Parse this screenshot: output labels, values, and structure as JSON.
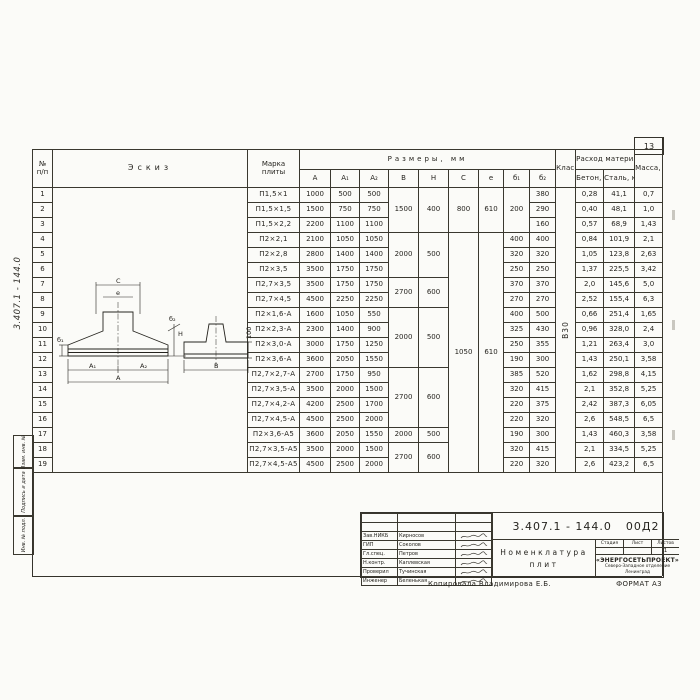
{
  "page": {
    "sheet_number": "13",
    "margin_doc_number": "3.407.1 - 144.0",
    "stamps": [
      "Взам. инв. №",
      "Подпись и дата",
      "Инв. № подл."
    ],
    "footer_note": "Копировала  Владимирова Е.Б.",
    "footer_format": "ФОРМАТ А3"
  },
  "table": {
    "header": {
      "num_top": "№",
      "num_bottom": "п/п",
      "sketch": "Эскиз",
      "mark_1": "Марка",
      "mark_2": "плиты",
      "dims": "Размеры,  мм",
      "dim_cols": [
        "A",
        "A₁",
        "A₂",
        "B",
        "H",
        "C",
        "e",
        "б₁",
        "б₂"
      ],
      "concrete_class": "Класс бетона",
      "materials": "Расход материалов",
      "material_cols": [
        "Бетон, м³",
        "Сталь, кг"
      ],
      "mass": "Масса, т"
    },
    "rows": [
      [
        {
          "t": "1",
          "n": "row-num"
        },
        {
          "t": "",
          "rs": 19,
          "k": "sk",
          "n": "sketch-cell"
        },
        {
          "t": "П1,5×1",
          "k": "mk",
          "n": "plate-mark"
        },
        {
          "t": "1000"
        },
        {
          "t": "500"
        },
        {
          "t": "500"
        },
        {
          "t": "1500",
          "rs": 3
        },
        {
          "t": "400",
          "rs": 3
        },
        {
          "t": "800",
          "rs": 3
        },
        {
          "t": "610",
          "rs": 3
        },
        {
          "t": "200",
          "rs": 3
        },
        {
          "t": "380"
        },
        {
          "t": "В30",
          "rs": 19,
          "k": "vc",
          "n": "concrete-class"
        },
        {
          "t": "0,28"
        },
        {
          "t": "41,1"
        },
        {
          "t": "0,7"
        }
      ],
      [
        {
          "t": "2",
          "n": "row-num"
        },
        {
          "t": "П1,5×1,5",
          "k": "mk",
          "n": "plate-mark"
        },
        {
          "t": "1500"
        },
        {
          "t": "750"
        },
        {
          "t": "750"
        },
        {
          "t": "290"
        },
        {
          "t": "0,40"
        },
        {
          "t": "48,1"
        },
        {
          "t": "1,0"
        }
      ],
      [
        {
          "t": "3",
          "n": "row-num"
        },
        {
          "t": "П1,5×2,2",
          "k": "mk",
          "n": "plate-mark"
        },
        {
          "t": "2200"
        },
        {
          "t": "1100"
        },
        {
          "t": "1100"
        },
        {
          "t": "160"
        },
        {
          "t": "0,57"
        },
        {
          "t": "68,9"
        },
        {
          "t": "1,43"
        }
      ],
      [
        {
          "t": "4",
          "n": "row-num"
        },
        {
          "t": "П2×2,1",
          "k": "mk",
          "n": "plate-mark"
        },
        {
          "t": "2100"
        },
        {
          "t": "1050"
        },
        {
          "t": "1050"
        },
        {
          "t": "2000",
          "rs": 3
        },
        {
          "t": "500",
          "rs": 3
        },
        {
          "t": "1050",
          "rs": 16
        },
        {
          "t": "610",
          "rs": 16
        },
        {
          "t": "400"
        },
        {
          "t": "400"
        },
        {
          "t": "0,84"
        },
        {
          "t": "101,9"
        },
        {
          "t": "2,1"
        }
      ],
      [
        {
          "t": "5",
          "n": "row-num"
        },
        {
          "t": "П2×2,8",
          "k": "mk",
          "n": "plate-mark"
        },
        {
          "t": "2800"
        },
        {
          "t": "1400"
        },
        {
          "t": "1400"
        },
        {
          "t": "320"
        },
        {
          "t": "320"
        },
        {
          "t": "1,05"
        },
        {
          "t": "123,8"
        },
        {
          "t": "2,63"
        }
      ],
      [
        {
          "t": "6",
          "n": "row-num"
        },
        {
          "t": "П2×3,5",
          "k": "mk",
          "n": "plate-mark"
        },
        {
          "t": "3500"
        },
        {
          "t": "1750"
        },
        {
          "t": "1750"
        },
        {
          "t": "250"
        },
        {
          "t": "250"
        },
        {
          "t": "1,37"
        },
        {
          "t": "225,5"
        },
        {
          "t": "3,42"
        }
      ],
      [
        {
          "t": "7",
          "n": "row-num"
        },
        {
          "t": "П2,7×3,5",
          "k": "mk",
          "n": "plate-mark"
        },
        {
          "t": "3500"
        },
        {
          "t": "1750"
        },
        {
          "t": "1750"
        },
        {
          "t": "2700",
          "rs": 2
        },
        {
          "t": "600",
          "rs": 2
        },
        {
          "t": "370"
        },
        {
          "t": "370"
        },
        {
          "t": "2,0"
        },
        {
          "t": "145,6"
        },
        {
          "t": "5,0"
        }
      ],
      [
        {
          "t": "8",
          "n": "row-num"
        },
        {
          "t": "П2,7×4,5",
          "k": "mk",
          "n": "plate-mark"
        },
        {
          "t": "4500"
        },
        {
          "t": "2250"
        },
        {
          "t": "2250"
        },
        {
          "t": "270"
        },
        {
          "t": "270"
        },
        {
          "t": "2,52"
        },
        {
          "t": "155,4"
        },
        {
          "t": "6,3"
        }
      ],
      [
        {
          "t": "9",
          "n": "row-num"
        },
        {
          "t": "П2×1,6-А",
          "k": "mk",
          "n": "plate-mark"
        },
        {
          "t": "1600"
        },
        {
          "t": "1050"
        },
        {
          "t": "550"
        },
        {
          "t": "2000",
          "rs": 4
        },
        {
          "t": "500",
          "rs": 4
        },
        {
          "t": "400"
        },
        {
          "t": "500"
        },
        {
          "t": "0,66"
        },
        {
          "t": "251,4"
        },
        {
          "t": "1,65"
        }
      ],
      [
        {
          "t": "10",
          "n": "row-num"
        },
        {
          "t": "П2×2,3-А",
          "k": "mk",
          "n": "plate-mark"
        },
        {
          "t": "2300"
        },
        {
          "t": "1400"
        },
        {
          "t": "900"
        },
        {
          "t": "325"
        },
        {
          "t": "430"
        },
        {
          "t": "0,96"
        },
        {
          "t": "328,0"
        },
        {
          "t": "2,4"
        }
      ],
      [
        {
          "t": "11",
          "n": "row-num"
        },
        {
          "t": "П2×3,0-А",
          "k": "mk",
          "n": "plate-mark"
        },
        {
          "t": "3000"
        },
        {
          "t": "1750"
        },
        {
          "t": "1250"
        },
        {
          "t": "250"
        },
        {
          "t": "355"
        },
        {
          "t": "1,21"
        },
        {
          "t": "263,4"
        },
        {
          "t": "3,0"
        }
      ],
      [
        {
          "t": "12",
          "n": "row-num"
        },
        {
          "t": "П2×3,6-А",
          "k": "mk",
          "n": "plate-mark"
        },
        {
          "t": "3600"
        },
        {
          "t": "2050"
        },
        {
          "t": "1550"
        },
        {
          "t": "190"
        },
        {
          "t": "300"
        },
        {
          "t": "1,43"
        },
        {
          "t": "250,1"
        },
        {
          "t": "3,58"
        }
      ],
      [
        {
          "t": "13",
          "n": "row-num"
        },
        {
          "t": "П2,7×2,7-А",
          "k": "mk",
          "n": "plate-mark"
        },
        {
          "t": "2700"
        },
        {
          "t": "1750"
        },
        {
          "t": "950"
        },
        {
          "t": "2700",
          "rs": 4
        },
        {
          "t": "600",
          "rs": 4
        },
        {
          "t": "385"
        },
        {
          "t": "520"
        },
        {
          "t": "1,62"
        },
        {
          "t": "298,8"
        },
        {
          "t": "4,15"
        }
      ],
      [
        {
          "t": "14",
          "n": "row-num"
        },
        {
          "t": "П2,7×3,5-А",
          "k": "mk",
          "n": "plate-mark"
        },
        {
          "t": "3500"
        },
        {
          "t": "2000"
        },
        {
          "t": "1500"
        },
        {
          "t": "320"
        },
        {
          "t": "415"
        },
        {
          "t": "2,1"
        },
        {
          "t": "352,8"
        },
        {
          "t": "5,25"
        }
      ],
      [
        {
          "t": "15",
          "n": "row-num"
        },
        {
          "t": "П2,7×4,2-А",
          "k": "mk",
          "n": "plate-mark"
        },
        {
          "t": "4200"
        },
        {
          "t": "2500"
        },
        {
          "t": "1700"
        },
        {
          "t": "220"
        },
        {
          "t": "375"
        },
        {
          "t": "2,42"
        },
        {
          "t": "387,3"
        },
        {
          "t": "6,05"
        }
      ],
      [
        {
          "t": "16",
          "n": "row-num"
        },
        {
          "t": "П2,7×4,5-А",
          "k": "mk",
          "n": "plate-mark"
        },
        {
          "t": "4500"
        },
        {
          "t": "2500"
        },
        {
          "t": "2000"
        },
        {
          "t": "220"
        },
        {
          "t": "320"
        },
        {
          "t": "2,6"
        },
        {
          "t": "548,5"
        },
        {
          "t": "6,5"
        }
      ],
      [
        {
          "t": "17",
          "n": "row-num"
        },
        {
          "t": "П2×3,6-А5",
          "k": "mk",
          "n": "plate-mark"
        },
        {
          "t": "3600"
        },
        {
          "t": "2050"
        },
        {
          "t": "1550"
        },
        {
          "t": "2000"
        },
        {
          "t": "500"
        },
        {
          "t": "190"
        },
        {
          "t": "300"
        },
        {
          "t": "1,43"
        },
        {
          "t": "460,3"
        },
        {
          "t": "3,58"
        }
      ],
      [
        {
          "t": "18",
          "n": "row-num"
        },
        {
          "t": "П2,7×3,5-А5",
          "k": "mk",
          "n": "plate-mark"
        },
        {
          "t": "3500"
        },
        {
          "t": "2000"
        },
        {
          "t": "1500"
        },
        {
          "t": "2700",
          "rs": 2
        },
        {
          "t": "600",
          "rs": 2
        },
        {
          "t": "320"
        },
        {
          "t": "415"
        },
        {
          "t": "2,1"
        },
        {
          "t": "334,5"
        },
        {
          "t": "5,25"
        }
      ],
      [
        {
          "t": "19",
          "n": "row-num"
        },
        {
          "t": "П2,7×4,5-А5",
          "k": "mk",
          "n": "plate-mark"
        },
        {
          "t": "4500"
        },
        {
          "t": "2500"
        },
        {
          "t": "2000"
        },
        {
          "t": "220"
        },
        {
          "t": "320"
        },
        {
          "t": "2,6"
        },
        {
          "t": "423,2"
        },
        {
          "t": "6,5"
        }
      ]
    ]
  },
  "sketch": {
    "c": "C",
    "e": "e",
    "a1": "A₁",
    "a2": "A₂",
    "a": "A",
    "b1": "б₁",
    "b2": "б₂",
    "h": "H",
    "b": "B",
    "dim100": "100"
  },
  "title_block": {
    "doc_number": "3.407.1 - 144.0",
    "doc_suffix": "00Д2",
    "title_line1": "Номенклатура",
    "title_line2": "плит",
    "stage_label": "Стадия",
    "sheet_label": "Лист",
    "sheets_label": "Листов",
    "stage_value": "",
    "sheet_value": "",
    "sheets_value": "1",
    "org_name": "«ЭНЕРГОСЕТЬПРОЕКТ»",
    "org_branch": "Северо-Западное отделение",
    "org_city": "Ленинград",
    "people": [
      {
        "role": "Зав.НИКБ",
        "name": "Кирносов"
      },
      {
        "role": "ГИП",
        "name": "Соколов"
      },
      {
        "role": "Гл.спец.",
        "name": "Петров"
      },
      {
        "role": "Н.контр.",
        "name": "Каплевская"
      },
      {
        "role": "Проверил",
        "name": "Тучинская"
      },
      {
        "role": "Инженер",
        "name": "Беленькая"
      }
    ]
  }
}
